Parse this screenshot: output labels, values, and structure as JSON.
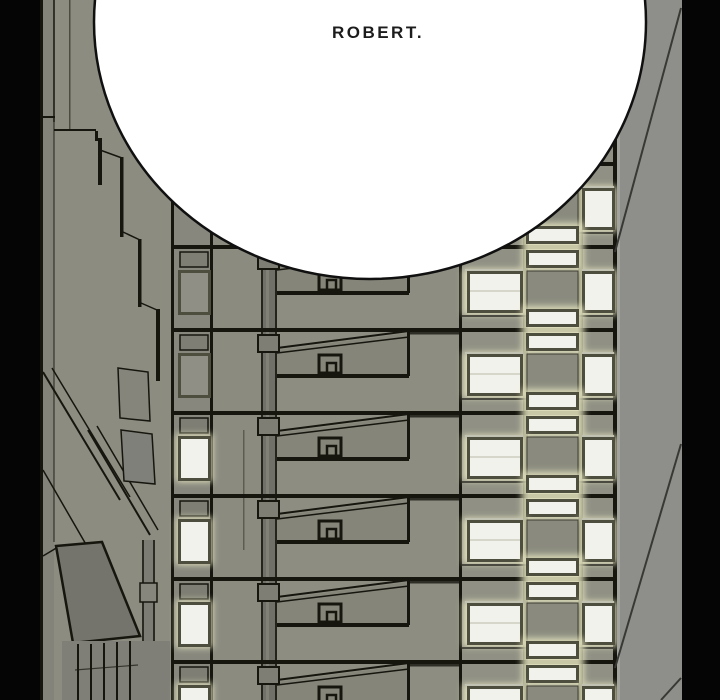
{
  "speech_bubble": {
    "text": "ROBERT."
  },
  "palette": {
    "black": "#050505",
    "line": "#16160f",
    "building": "#8c8c81",
    "strip": "#87877d",
    "wall": "#8b8b80",
    "wedge-wall": "#8d8d81",
    "facade": "#909084",
    "side-wall": "#8e8e8b",
    "frame": "#4e4e3f",
    "lit": "#f2f2ec",
    "glow": "#e8e8c2",
    "unlit": "#8a8b7e",
    "bubble": "#ffffff",
    "bubble-outline": "#101010",
    "text": "#1c1c1c"
  }
}
